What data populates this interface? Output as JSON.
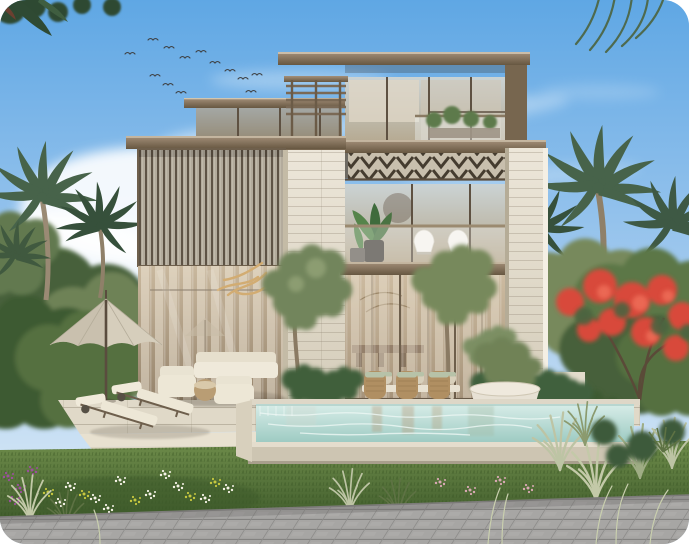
{
  "meta": {
    "type": "architectural-render",
    "description": "Daytime exterior rendering of a modern three-storey villa with louvered facade, travertine piers, swimming pool, lawn and palm garden"
  },
  "palette": {
    "sky_top": "#5FA7E4",
    "sky_mid": "#A7CCEF",
    "sky_horizon": "#E3EFF8",
    "cloud_white": "#FFFFFF",
    "bird_dark": "#3F4245",
    "foliage_dark": "#33502F",
    "foliage_mid": "#5C7747",
    "foliage_light": "#8CA06B",
    "olive_green": "#77895C",
    "palm_green": "#47634A",
    "palm_green_dark": "#36503B",
    "trunk_brown": "#99896F",
    "flame_red": "#D84A3A",
    "flame_red_light": "#F0705A",
    "roof_top": "#A4907A",
    "roof_bottom": "#675741",
    "roof_edge_light": "#D9CEB9",
    "stone_light": "#ECE6D9",
    "stone_dark": "#D3CBB8",
    "glass_cool_top": "#CBD3D4",
    "glass_cool_bottom": "#B4A68B",
    "glass_warm_top": "#C9B89E",
    "glass_warm_bottom": "#96846C",
    "curtain_cream": "#F3ECDD",
    "louver_base": "#B3AB9C",
    "louver_slat": "#5E5345",
    "chevron_base": "#C8BFAD",
    "chevron_dark": "#453C2F",
    "frame_bronze": "#6E5F4C",
    "water_light": "#D8EDE8",
    "water_deep": "#9ECBC3",
    "water_face": "#CDC5B2",
    "coping": "#DED7C7",
    "deck_light": "#E0D9C8",
    "step_light": "#E8E1D0",
    "lawn_light": "#6E8C4A",
    "lawn_dark": "#3E5A2B",
    "plume_grass": "#C3C9A8",
    "grass_green": "#5E7244",
    "paver_light": "#ACABA9",
    "paver_dark": "#8A8987",
    "cushion_cream": "#EDE7D6",
    "wicker_tan": "#B08F62",
    "cushion_sage": "#B7C2A8",
    "umbrella_beige": "#D6CEBC",
    "pole_bronze": "#5A4C3E",
    "gold_branch": "#D2AC72",
    "white_chair": "#F4F2EC",
    "planter_light": "#E7E1D4",
    "flower_white": "#F6F3E7",
    "flower_yellow": "#C6C73F",
    "flower_purple": "#9C4F9E",
    "flower_pink": "#D9A9B4",
    "interior_warm": "#D9C5A8",
    "pool_reflection": "#B89A78"
  },
  "scene": {
    "setting": "Modern three-storey luxury villa exterior, daytime",
    "sky": {
      "birds": 16,
      "clouds": "wispy white"
    },
    "villa": {
      "floors": 3,
      "facade": [
        "vertical louver screen",
        "travertine stone piers",
        "bronze framed glazing",
        "chevron pergola soffit",
        "glass balustrade balcony",
        "rooftop slat pergola"
      ]
    },
    "landscape": [
      "date palms",
      "olive trees",
      "red flame tree",
      "tropical shrubs",
      "ornamental grasses",
      "flower bed",
      "lawn",
      "paver walkway"
    ],
    "pool": {
      "style": "raised infinity edge",
      "water": "pale turquoise"
    },
    "furniture": {
      "parasol": 1,
      "sun_loungers": 2,
      "outdoor_armchairs": 2,
      "outdoor_sofa": 1,
      "balcony_chairs": 2,
      "dining_chairs": 6,
      "dining_table": 1,
      "round_planter": 1
    }
  }
}
